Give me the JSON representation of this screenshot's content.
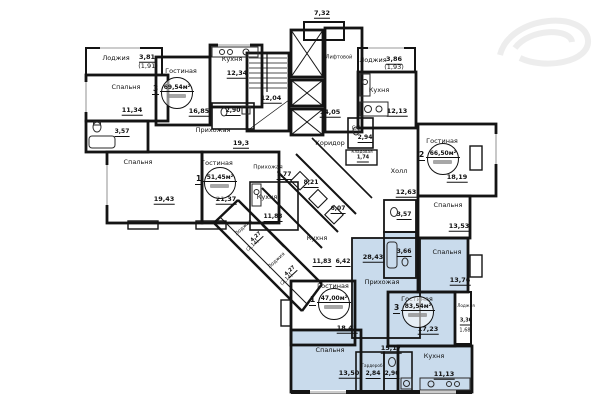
{
  "plan_title": "Floor plan — residential section",
  "colors": {
    "wall": "#141414",
    "highlight_apartment": "#c9dbec",
    "background": "#ffffff",
    "fixture": "#2a2a2a"
  },
  "apartment_stamps": [
    {
      "rooms": "3",
      "total_area": "69,54м²",
      "x": 176,
      "y": 92
    },
    {
      "rooms": "2",
      "total_area": "66,50м²",
      "x": 442,
      "y": 158
    },
    {
      "rooms": "1",
      "total_area": "51,45м²",
      "x": 219,
      "y": 182
    },
    {
      "rooms": "1",
      "total_area": "47,00м²",
      "x": 333,
      "y": 303
    },
    {
      "rooms": "3",
      "total_area": "83,54м²",
      "x": 417,
      "y": 311
    }
  ],
  "labels": [
    {
      "text": "7,32",
      "x": 322,
      "y": 14,
      "u": true
    },
    {
      "text": "Лоджия",
      "x": 116,
      "y": 58
    },
    {
      "text": "3,81",
      "x": 147,
      "y": 58,
      "u": true
    },
    {
      "text": "(1,91)",
      "x": 148,
      "y": 66
    },
    {
      "text": "Спальня",
      "x": 126,
      "y": 87
    },
    {
      "text": "11,34",
      "x": 132,
      "y": 111,
      "u": true
    },
    {
      "text": "Гостиная",
      "x": 181,
      "y": 71
    },
    {
      "text": "16,85",
      "x": 199,
      "y": 112,
      "u": true
    },
    {
      "text": "Кухня",
      "x": 232,
      "y": 59
    },
    {
      "text": "12,34",
      "x": 237,
      "y": 74,
      "u": true
    },
    {
      "text": "2,90",
      "x": 233,
      "y": 112,
      "u": true,
      "size": 6
    },
    {
      "text": "3,57",
      "x": 122,
      "y": 133,
      "u": true,
      "size": 6
    },
    {
      "text": "Прихожая",
      "x": 213,
      "y": 130
    },
    {
      "text": "19,3",
      "x": 241,
      "y": 144,
      "u": true
    },
    {
      "text": "12,04",
      "x": 271,
      "y": 99,
      "u": true
    },
    {
      "text": "Лифтовой",
      "x": 339,
      "y": 58,
      "size": 5
    },
    {
      "text": "14,05",
      "x": 330,
      "y": 113,
      "u": true
    },
    {
      "text": "Коридор",
      "x": 330,
      "y": 143
    },
    {
      "text": "С/У",
      "x": 356,
      "y": 129,
      "size": 5
    },
    {
      "text": "2,94",
      "x": 365,
      "y": 139,
      "u": true,
      "size": 6
    },
    {
      "text": "Кладовая",
      "x": 362,
      "y": 152,
      "size": 4.2
    },
    {
      "text": "1,74",
      "x": 363,
      "y": 159,
      "u": true,
      "size": 5
    },
    {
      "text": "Холл",
      "x": 399,
      "y": 171
    },
    {
      "text": "12,63",
      "x": 406,
      "y": 193,
      "u": true
    },
    {
      "text": "Лоджия",
      "x": 373,
      "y": 60
    },
    {
      "text": "3,86",
      "x": 394,
      "y": 60,
      "u": true
    },
    {
      "text": "(1,93)",
      "x": 394,
      "y": 67
    },
    {
      "text": "Кухня",
      "x": 379,
      "y": 90
    },
    {
      "text": "12,13",
      "x": 397,
      "y": 112,
      "u": true
    },
    {
      "text": "Гостиная",
      "x": 442,
      "y": 141
    },
    {
      "text": "18,19",
      "x": 457,
      "y": 178,
      "u": true
    },
    {
      "text": "Спальня",
      "x": 448,
      "y": 205
    },
    {
      "text": "13,53",
      "x": 459,
      "y": 227,
      "u": true
    },
    {
      "text": "3,57",
      "x": 404,
      "y": 216,
      "u": true,
      "size": 6
    },
    {
      "text": "Спальня",
      "x": 138,
      "y": 162
    },
    {
      "text": "19,43",
      "x": 164,
      "y": 200,
      "u": true
    },
    {
      "text": "Гостиная",
      "x": 217,
      "y": 163
    },
    {
      "text": "21,37",
      "x": 226,
      "y": 200,
      "u": true
    },
    {
      "text": "Прихожая",
      "x": 268,
      "y": 168,
      "size": 5.5
    },
    {
      "text": "7,77",
      "x": 284,
      "y": 176,
      "u": true,
      "size": 6
    },
    {
      "text": "8,21",
      "x": 311,
      "y": 184,
      "u": true,
      "size": 6
    },
    {
      "text": "Кухня",
      "x": 267,
      "y": 197
    },
    {
      "text": "11,83",
      "x": 273,
      "y": 218,
      "u": true,
      "size": 6
    },
    {
      "text": "6,07",
      "x": 338,
      "y": 210,
      "u": true,
      "size": 6
    },
    {
      "text": "Лоджия",
      "x": 244,
      "y": 228,
      "rot": -43,
      "size": 5
    },
    {
      "text": "4,27",
      "x": 257,
      "y": 238,
      "rot": -43,
      "size": 5,
      "u": true
    },
    {
      "text": "(2,14)",
      "x": 253,
      "y": 246,
      "rot": -43,
      "size": 5
    },
    {
      "text": "Лоджия",
      "x": 277,
      "y": 261,
      "rot": -43,
      "size": 5
    },
    {
      "text": "4,27",
      "x": 291,
      "y": 272,
      "rot": -43,
      "size": 5,
      "u": true
    },
    {
      "text": "(2,14)",
      "x": 287,
      "y": 280,
      "rot": -43,
      "size": 5
    },
    {
      "text": "Кухня",
      "x": 317,
      "y": 238
    },
    {
      "text": "11,83",
      "x": 322,
      "y": 263,
      "u": true,
      "size": 6
    },
    {
      "text": "6,42",
      "x": 343,
      "y": 263,
      "u": true,
      "size": 6
    },
    {
      "text": "28,43",
      "x": 373,
      "y": 258,
      "u": true
    },
    {
      "text": "3,66",
      "x": 404,
      "y": 253,
      "u": true,
      "size": 6
    },
    {
      "text": "Прихожая",
      "x": 382,
      "y": 282
    },
    {
      "text": "Спальня",
      "x": 447,
      "y": 252
    },
    {
      "text": "13,76",
      "x": 460,
      "y": 281,
      "u": true
    },
    {
      "text": "Гостиная",
      "x": 333,
      "y": 286
    },
    {
      "text": "18,41",
      "x": 347,
      "y": 329,
      "u": true
    },
    {
      "text": "Гостиная",
      "x": 417,
      "y": 299
    },
    {
      "text": "17,23",
      "x": 428,
      "y": 330,
      "u": true
    },
    {
      "text": "Лоджия",
      "x": 466,
      "y": 306,
      "size": 4.2
    },
    {
      "text": "3,36",
      "x": 466,
      "y": 322,
      "u": true,
      "size": 5
    },
    {
      "text": "1,68",
      "x": 465,
      "y": 331,
      "size": 5
    },
    {
      "text": "15,17",
      "x": 391,
      "y": 349,
      "u": true
    },
    {
      "text": "Спальня",
      "x": 330,
      "y": 350
    },
    {
      "text": "13,50",
      "x": 349,
      "y": 374,
      "u": true
    },
    {
      "text": "Гардероб",
      "x": 372,
      "y": 366,
      "size": 4.2
    },
    {
      "text": "2,84",
      "x": 373,
      "y": 375,
      "u": true,
      "size": 6
    },
    {
      "text": "2,90",
      "x": 392,
      "y": 375,
      "u": true,
      "size": 6
    },
    {
      "text": "Кухня",
      "x": 434,
      "y": 356
    },
    {
      "text": "11,13",
      "x": 444,
      "y": 375,
      "u": true
    }
  ]
}
